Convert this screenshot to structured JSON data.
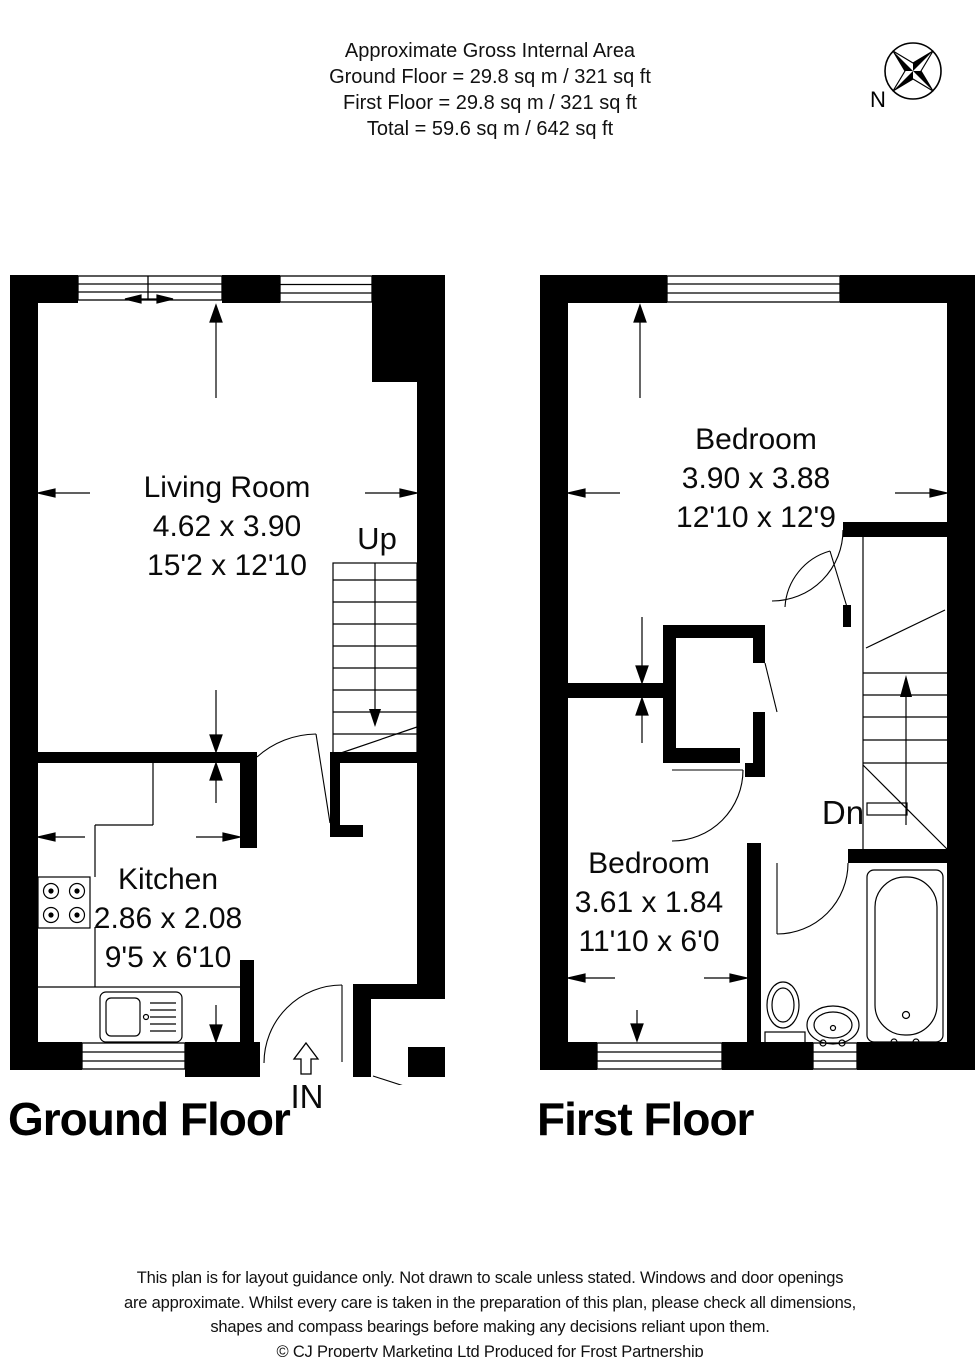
{
  "header": {
    "title": "Approximate Gross Internal Area",
    "ground_area": "Ground Floor = 29.8 sq m / 321 sq ft",
    "first_area": "First Floor = 29.8 sq m / 321 sq ft",
    "total_area": "Total = 59.6 sq m / 642 sq ft"
  },
  "compass": {
    "north_label": "N"
  },
  "ground_floor": {
    "title": "Ground Floor",
    "living_room": {
      "name": "Living Room",
      "metric": "4.62 x 3.90",
      "imperial": "15'2 x 12'10"
    },
    "kitchen": {
      "name": "Kitchen",
      "metric": "2.86 x 2.08",
      "imperial": "9'5 x 6'10"
    },
    "stairs_label": "Up",
    "entrance_label": "IN"
  },
  "first_floor": {
    "title": "First Floor",
    "bedroom_front": {
      "name": "Bedroom",
      "metric": "3.90 x 3.88",
      "imperial": "12'10 x 12'9"
    },
    "bedroom_back": {
      "name": "Bedroom",
      "metric": "3.61 x 1.84",
      "imperial": "11'10 x 6'0"
    },
    "stairs_label": "Dn"
  },
  "footer": {
    "line1": "This plan is for layout guidance only. Not drawn to scale unless stated. Windows and door openings",
    "line2": "are approximate. Whilst every care is taken in the preparation of this plan, please check all dimensions,",
    "line3": "shapes and compass bearings before making any decisions reliant upon them.",
    "line4": "© CJ Property Marketing Ltd Produced for Frost Partnership"
  }
}
